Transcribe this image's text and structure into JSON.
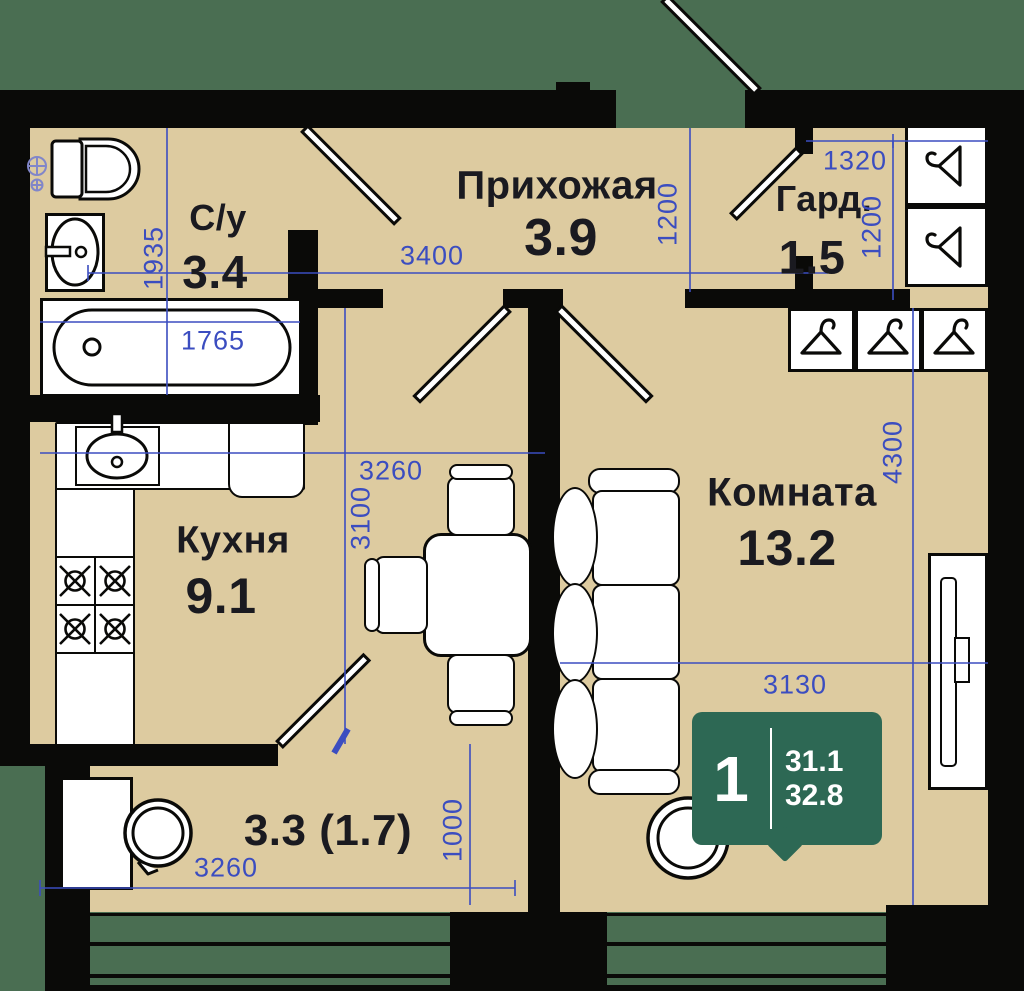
{
  "unit_badge": {
    "rooms_count": "1",
    "area_living": "31.1",
    "area_total": "32.8"
  },
  "rooms": [
    {
      "name": "С/у",
      "area": "3.4"
    },
    {
      "name": "Прихожая",
      "area": "3.9"
    },
    {
      "name": "Гард.",
      "area": "1.5"
    },
    {
      "name": "Кухня",
      "area": "9.1"
    },
    {
      "name": "Комната",
      "area": "13.2"
    },
    {
      "name": "Балкон",
      "area": "3.3 (1.7)"
    }
  ],
  "dimensions": {
    "bathroom_width": "1935",
    "bathtub_length": "1765",
    "hallway_width": "3400",
    "hallway_depth": "1200",
    "wardrobe_width": "1320",
    "wardrobe_depth": "1200",
    "room_length": "4300",
    "room_width": "3130",
    "kitchen_width": "3260",
    "kitchen_depth": "3100",
    "balcony_width": "3260",
    "balcony_depth": "1000"
  },
  "colors": {
    "background": "#4a6e52",
    "floor": "#ddcba0",
    "walls": "#0a0a08",
    "dimension_blue": "#3b4dc0",
    "riser_blue": "#8186c9",
    "badge_green": "#2d6854"
  },
  "icons": {
    "hanger": "hanger-icon",
    "burner": "stove-burner-icon",
    "riser": "plumbing-riser-icon"
  }
}
